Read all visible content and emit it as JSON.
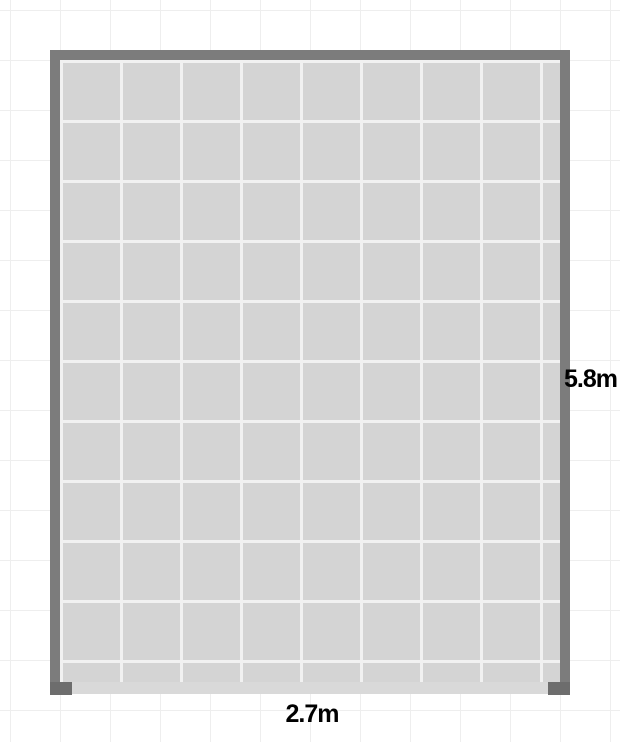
{
  "floorplan": {
    "dimensions": {
      "width_label": "2.7m",
      "height_label": "5.8m"
    },
    "colors": {
      "canvas_background": "#ffffff",
      "canvas_grid_line": "#eeeeee",
      "wall": "#7c7c7c",
      "wall_end_cap": "#6d6d6d",
      "floor": "#d4d4d4",
      "floor_grid_line": "#f1f1f1",
      "open_wall_strip": "#d9d9d9",
      "label_text": "#000000"
    }
  }
}
